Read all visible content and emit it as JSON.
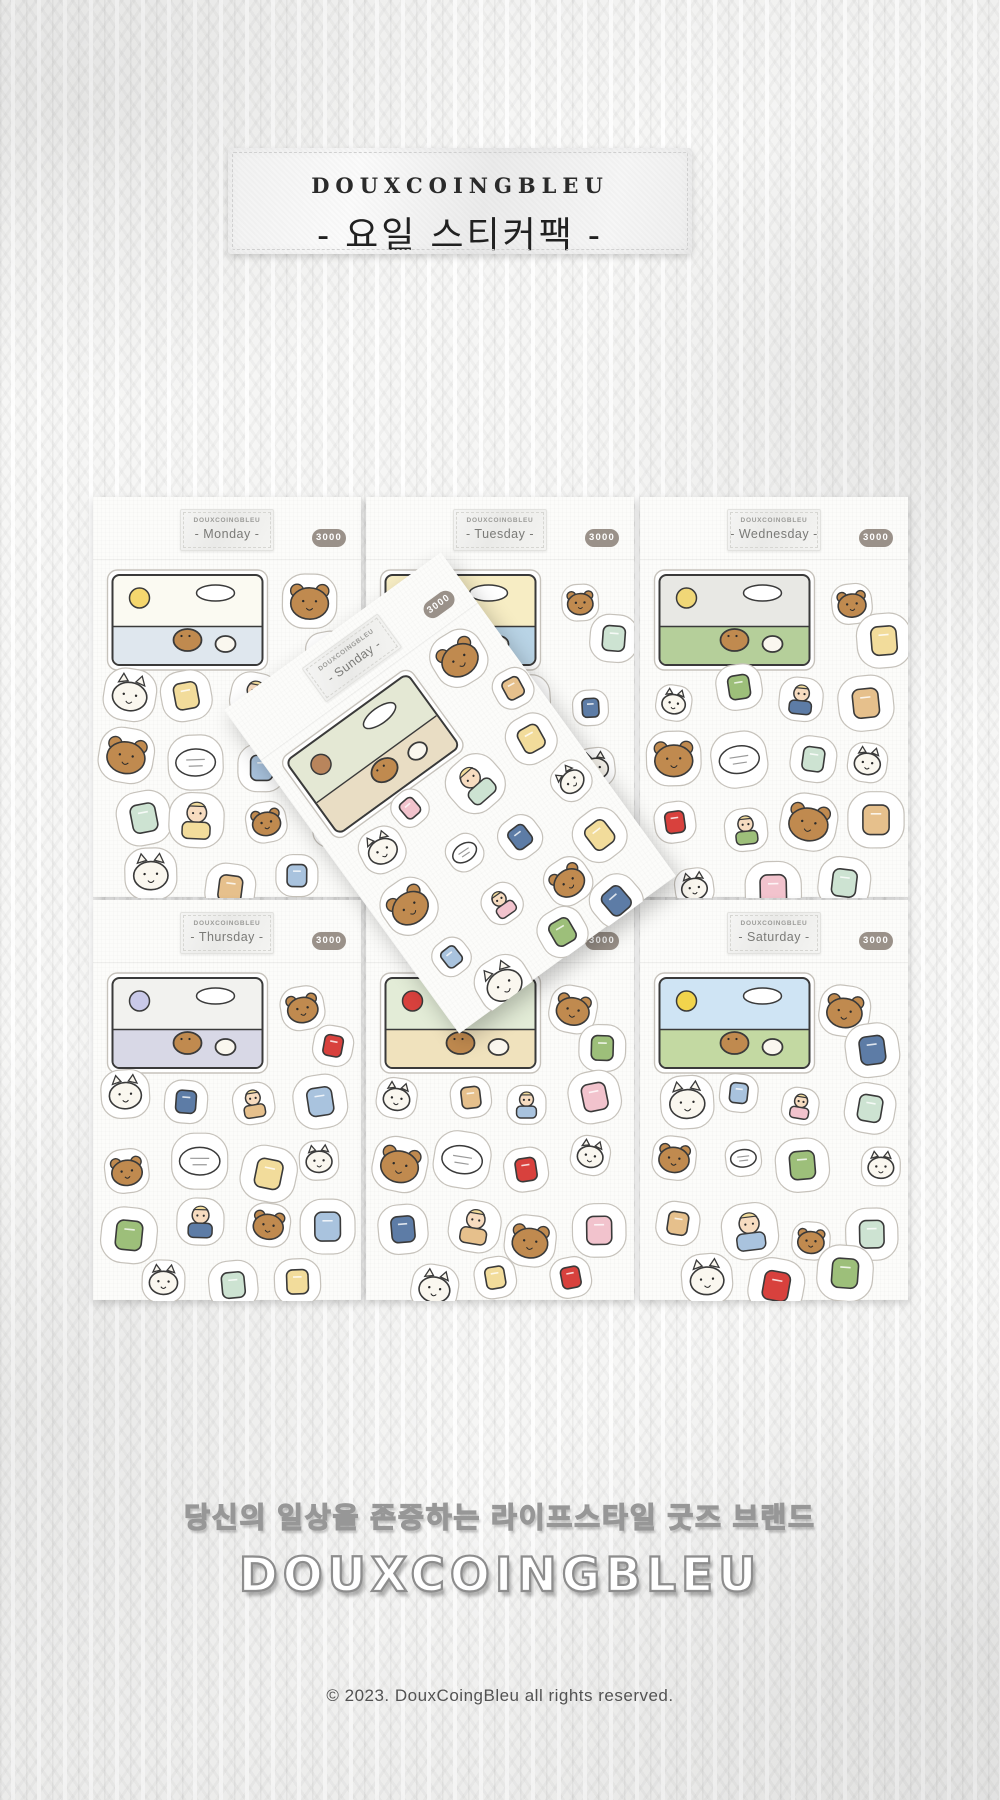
{
  "product": {
    "brand": "DOUXCOINGBLEU",
    "name_korean": "요일 스티커팩",
    "type": "weekday sticker pack set, 7 sheets"
  },
  "header_label": {
    "brand": "DOUXCOINGBLEU",
    "title": "- 요일 스티커팩 -"
  },
  "sheets": [
    {
      "day": "Monday",
      "brand": "DOUXCOINGBLEU",
      "label": "- Monday -",
      "price": "3000",
      "scene": {
        "bg": "#fbfaf2",
        "band": "#dfe7ee",
        "accent": "#f5d76e"
      },
      "motifs": [
        "city window scene 'OH, MY..'",
        "man at laptop 'Busy'",
        "dog sleeping on open book Zzz",
        "chef tasting soup in mint apron",
        "cat with pink neck pillow",
        "dog with milk carton 'Good morning'",
        "potted herbs",
        "radish",
        "onion",
        "green onion",
        "tomato",
        "milk jug",
        "toilet paper",
        "butter",
        "cats holding cutlery",
        "dog in shopping cart",
        "honey jar"
      ]
    },
    {
      "day": "Tuesday",
      "brand": "DOUXCOINGBLEU",
      "label": "- Tuesday -",
      "price": "3000",
      "scene": {
        "bg": "#f7edc4",
        "band": "#b9d4e6",
        "accent": "#ffffff"
      },
      "motifs": [
        "seaside bicycle ride scene with dog and cat",
        "toothpaste tube",
        "cat grooming",
        "man in blue jacket with coffee 'Sorry!'",
        "luggage tag",
        "dog lifting moving box",
        "pink rubber gloves",
        "dog brushing teeth",
        "soap bar",
        "hair brush",
        "spray bottle",
        "toothbrush"
      ]
    },
    {
      "day": "Wednesday",
      "brand": "DOUXCOINGBLEU",
      "label": "- Wednesday -",
      "price": "3000",
      "scene": {
        "bg": "#e8e8e4",
        "band": "#b5cf9a",
        "accent": "#f0d777"
      },
      "motifs": [
        "rainy bus stop scene with yellow umbrella",
        "tumbling cats",
        "cat at pink vanity mirror",
        "singing dog",
        "dog splashing in puddle",
        "person in yellow duck raincoat",
        "curly blonde lady with pink bag",
        "cosmetics",
        "white jacket on hanger",
        "dog in sweater 'FLEX'",
        "jeans",
        "socks",
        "cat in pink dress with shopping bags",
        "'DCB' sweater",
        "perfume bottle",
        "pink gloves",
        "lady at standing mirror"
      ]
    },
    {
      "day": "Thursday",
      "brand": "DOUXCOINGBLEU",
      "label": "- Thursday -",
      "price": "3000",
      "scene": {
        "bg": "#f2f2ef",
        "band": "#d8d8e6",
        "accent": "#c9c9e8"
      },
      "motifs": [
        "dog DJ disco scene with mirror ball",
        "magazine 'COOL!'",
        "dog in snack box with chips",
        "clothespins",
        "man with laptop in bed",
        "folded shirt",
        "laundry basket",
        "towel",
        "hanger",
        "iron",
        "dog in washing machine",
        "cat carrying books",
        "dumbbell daydream bubble",
        "detergent",
        "stack of books"
      ]
    },
    {
      "day": "Friday",
      "brand": "DOUXCOINGBLEU",
      "label": "- Friday -",
      "price": "3000",
      "label_covered_by_sunday_sheet": true,
      "scene": {
        "bg": "#e3ecd7",
        "band": "#f0e2bd",
        "accent": "#d8413d"
      },
      "motifs": [
        "dinner table scene with cat and dog",
        "wine bottle and glass",
        "chips bag",
        "chocolate",
        "dog eating candy",
        "doctor dog",
        "dog riding scooter",
        "duck with towel",
        "gumball machine with cat",
        "retro game pack",
        "running couple 'Go Home!'",
        "yellow star",
        "speaker"
      ]
    },
    {
      "day": "Saturday",
      "brand": "DOUXCOINGBLEU",
      "label": "- Saturday -",
      "price": "3000",
      "scene": {
        "bg": "#cfe4f4",
        "band": "#c3d9a2",
        "accent": "#f2d44c"
      },
      "motifs": [
        "road trip scene with yellow car",
        "three airplane windows",
        "sunglasses",
        "pink duffel bag",
        "green camera",
        "dog on sun lounger",
        "fish-shaped crackers",
        "campfire with dogs and cat",
        "blue airplane",
        "cat eating snack",
        "coins",
        "woman in pink beanie playing guitar",
        "bucket hat",
        "man at typewriter",
        "tent",
        "pink thermos",
        "crescent moon",
        "tickets",
        "man with suitcase"
      ]
    },
    {
      "day": "Sunday",
      "brand": "DOUXCOINGBLEU",
      "label": "- Sunday -",
      "price": "3000",
      "rotated_overlay": true,
      "scene": {
        "bg": "#e4e8d4",
        "band": "#e9ddc4",
        "accent": "#b9855c"
      },
      "motifs": [
        "dog reading newspaper in shower scene",
        "popcorn bucket",
        "cola cup",
        "dog thinking 'Love... monday?'",
        "dog reading 'FRI' paper",
        "globe",
        "pill bottle",
        "curly lady on phone",
        "diary",
        "dog hugging phone in armchair",
        "laptop on desk",
        "dog sleeping",
        "smartphone",
        "cat on bathtub",
        "pencil",
        "receipt",
        "'OH... monday...' man",
        "sparkle"
      ]
    }
  ],
  "footer": {
    "tagline": "당신의 일상을 존중하는 라이프스타일 굿즈 브랜드",
    "brand": "DOUXCOINGBLEU",
    "copyright": "© 2023. DouxCoingBleu all rights reserved."
  },
  "palette": {
    "outline": "#3a3a3a",
    "sticker_edge": "#c6c2bb",
    "paper": "#fcfcfa",
    "brown": "#c08a4f",
    "tan": "#e6c08c",
    "cream": "#faf7ef",
    "skin": "#f7dcc0",
    "blue": "#a9c3de",
    "navy": "#5d7ca6",
    "mint": "#cde3d2",
    "green": "#9dbf7a",
    "pink": "#f2c3cd",
    "red": "#d8413d",
    "yellow": "#f2dc9b",
    "badge_bg": "#9a9189",
    "label_text": "#7a7a77",
    "tag_text": "#2b2b2b"
  }
}
